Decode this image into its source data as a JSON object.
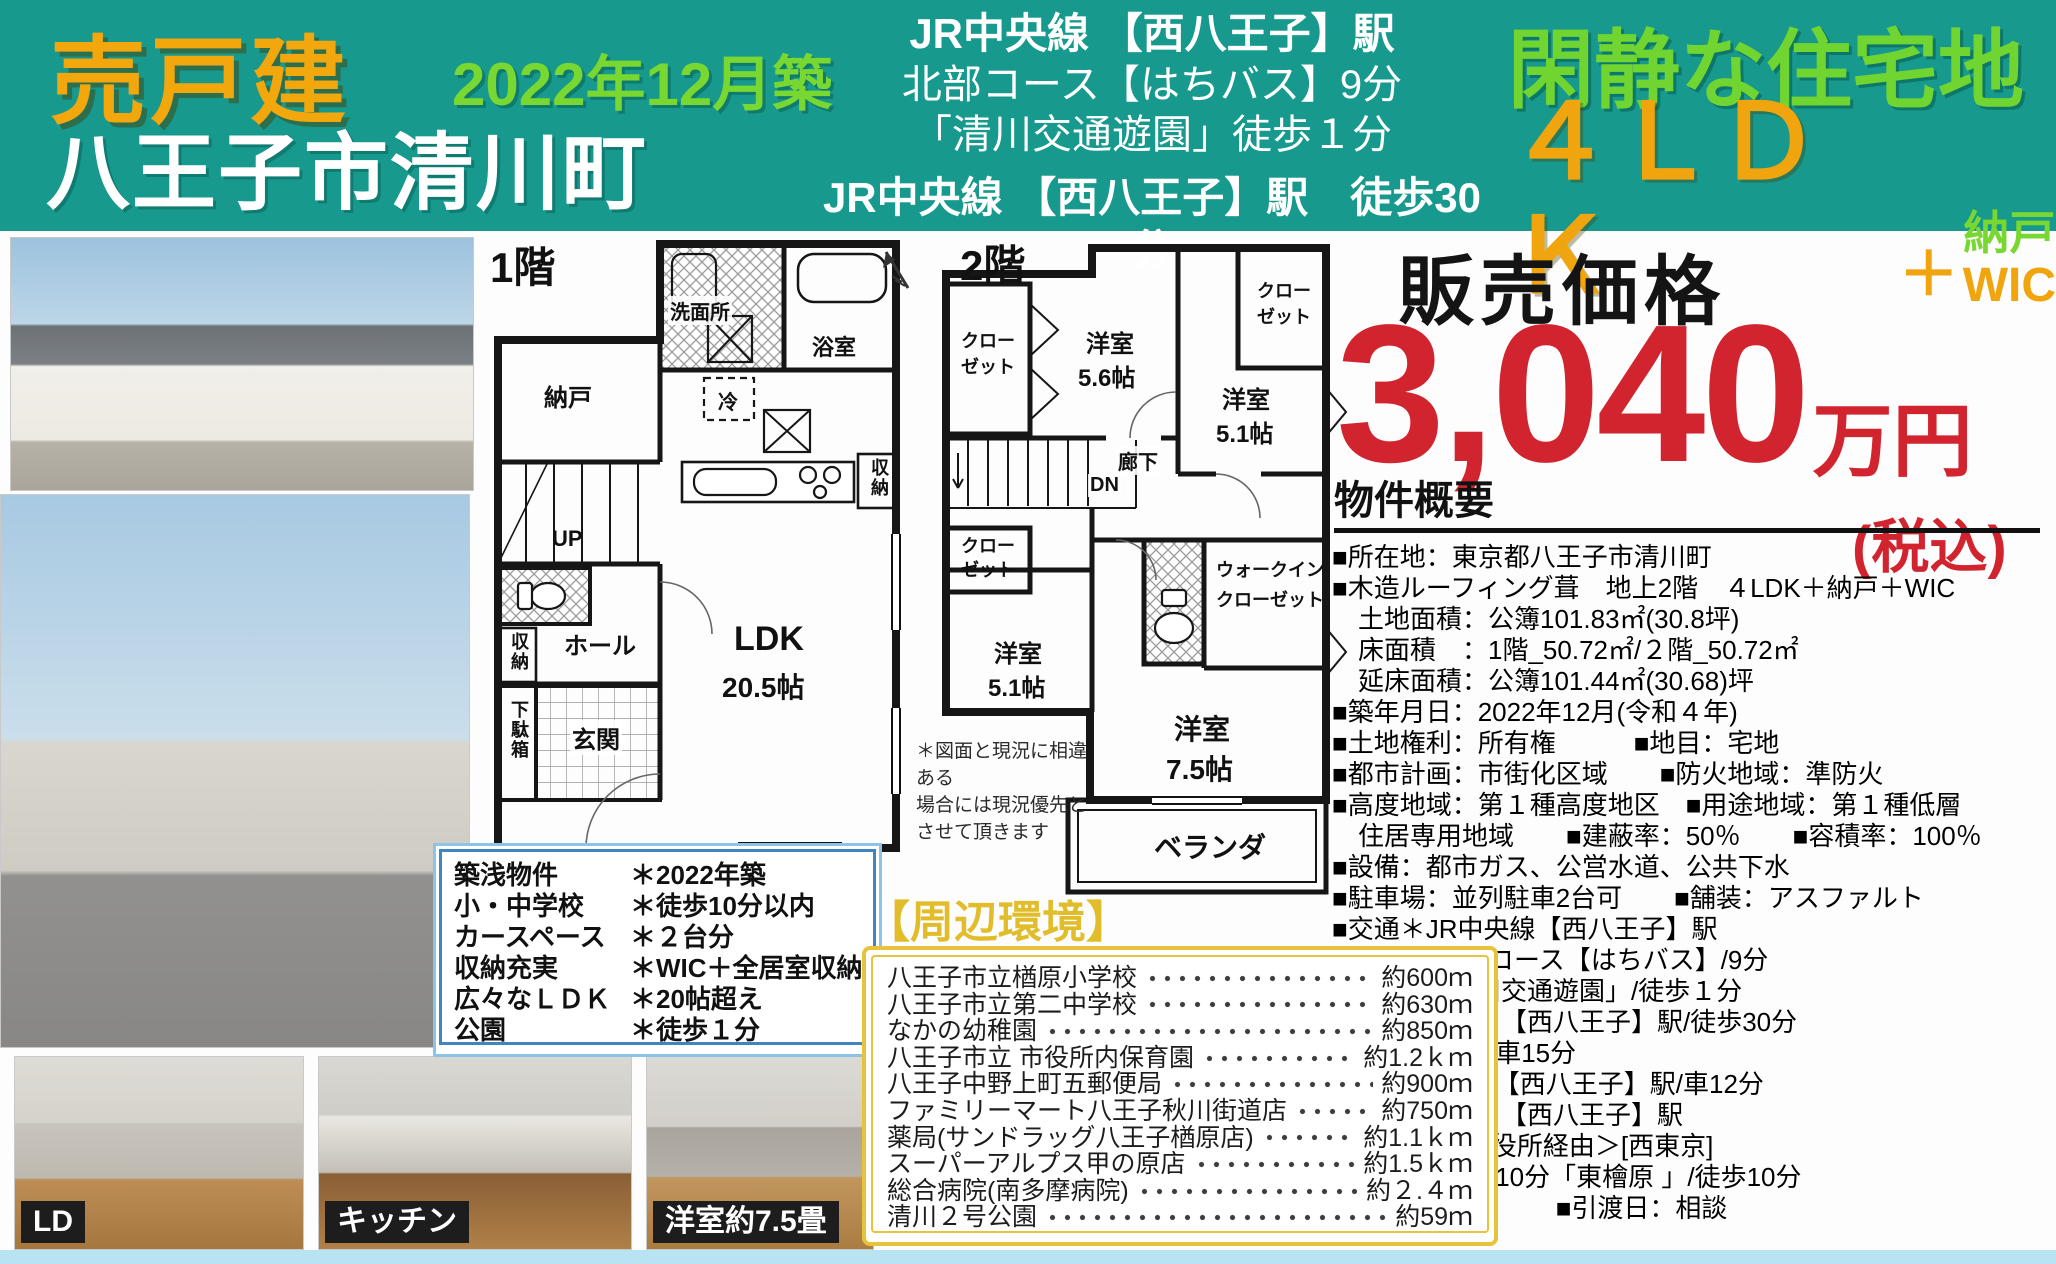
{
  "banner": {
    "sale_type": "売戸建",
    "built": "2022年12月築",
    "location": "八王子市清川町",
    "access": {
      "line1": "JR中央線 【西八王子】駅",
      "line2": "北部コース【はちバス】9分",
      "line3": "「清川交通遊園」徒歩１分",
      "line4": "JR中央線 【西八王子】駅　徒歩30分"
    },
    "catch": "閑静な住宅地",
    "plan": "４ＬＤＫ",
    "plan_plus": "＋",
    "plan_extra1": "納戸",
    "plan_extra2": "WIC"
  },
  "price": {
    "label": "販売価格",
    "amount": "3,040",
    "unit": "万円",
    "tax_note": "(税込)"
  },
  "overview": {
    "title": "物件概要",
    "lines": [
      "■所在地：東京都八王子市清川町",
      "■木造ルーフィング葺　地上2階　４LDK＋納戸＋WIC",
      "　土地面積：公簿101.83㎡(30.8坪)",
      "　床面積　：1階_50.72㎡/２階_50.72㎡",
      "　延床面積：公簿101.44㎡(30.68)坪",
      "■築年月日：2022年12月(令和４年)",
      "■土地権利：所有権　　　■地目：宅地",
      "■都市計画：市街化区域　　■防火地域：準防火",
      "■高度地域：第１種高度地区　■用途地域：第１種低層",
      "　住居専用地域　　■建蔽率：50％　　■容積率：100％",
      "■設備：都市ガス、公営水道、公共下水",
      "■駐車場：並列駐車2台可　　■舗装：アスファルト",
      "■交通＊JR中央線【西八王子】駅",
      "　　　　北部コース【はちバス】/9分",
      "　　　　「清川交通遊園」/徒歩１分",
      "　＊JR中央線 【西八王子】駅/徒歩30分",
      "　＊八王子IC/車15分",
      "　＊JR中央線【西八王子】駅/車12分",
      "　＊JR中央線 【西八王子】駅",
      "　　市02＜市役所経由＞[西東京]",
      "　　檜原町行/10分「東檜原 」/徒歩10分",
      "■現況：現住　　　■引渡日：相談"
    ]
  },
  "features": {
    "rows": [
      {
        "label": "築浅物件",
        "value": "＊2022年築"
      },
      {
        "label": "小・中学校",
        "value": "＊徒歩10分以内"
      },
      {
        "label": "カースペース",
        "value": "＊２台分"
      },
      {
        "label": "収納充実",
        "value": "＊WIC＋全居室収納"
      },
      {
        "label": "広々なＬＤＫ",
        "value": "＊20帖超え"
      },
      {
        "label": "公園",
        "value": "＊徒歩１分"
      }
    ]
  },
  "surroundings": {
    "title": "【周辺環境】",
    "items": [
      {
        "name": "八王子市立楢原小学校",
        "dist": "約600ｍ"
      },
      {
        "name": "八王子市立第二中学校",
        "dist": "約630ｍ"
      },
      {
        "name": "なかの幼稚園",
        "dist": "約850ｍ"
      },
      {
        "name": "八王子市立 市役所内保育園",
        "dist": "約1.2ｋｍ"
      },
      {
        "name": "八王子中野上町五郵便局",
        "dist": "約900ｍ"
      },
      {
        "name": "ファミリーマート八王子秋川街道店",
        "dist": "約750ｍ"
      },
      {
        "name": "薬局(サンドラッグ八王子楢原店)",
        "dist": "約1.1ｋｍ"
      },
      {
        "name": "スーパーアルプス甲の原店",
        "dist": "約1.5ｋｍ"
      },
      {
        "name": "総合病院(南多摩病院)",
        "dist": "約２.４ｍ"
      },
      {
        "name": "清川２号公園",
        "dist": "約59ｍ"
      }
    ]
  },
  "floorplans": {
    "disclaimer": "＊図面と現況に相違ある\n場合には現況優先と\nさせて頂きます",
    "f1": {
      "title": "1階",
      "nando": "納戸",
      "senmenjo": "洗面所",
      "yokushitsu": "浴室",
      "rei": "冷",
      "shunou_kitchen": "収納",
      "up": "UP",
      "shunou_hall": "収納",
      "hall": "ホール",
      "getabako": "下駄箱",
      "genkan": "玄関",
      "ldk": "LDK",
      "ldk_size": "20.5帖"
    },
    "f2": {
      "title": "2階",
      "closet_tl": "クローゼット",
      "closet_tr": "クローゼット",
      "closet_ml": "クローゼット",
      "r56": "洋室",
      "r56_size": "5.6帖",
      "r51a": "洋室",
      "r51a_size": "5.1帖",
      "rouka": "廊下",
      "dn": "DN",
      "r51b": "洋室",
      "r51b_size": "5.1帖",
      "wic_line1": "ウォークイン",
      "wic_line2": "クローゼット",
      "r75": "洋室",
      "r75_size": "7.5帖",
      "veranda": "ベランダ"
    }
  },
  "photos": {
    "caption_ld": "LD",
    "caption_kitchen": "キッチン",
    "caption_room": "洋室約7.5畳"
  }
}
